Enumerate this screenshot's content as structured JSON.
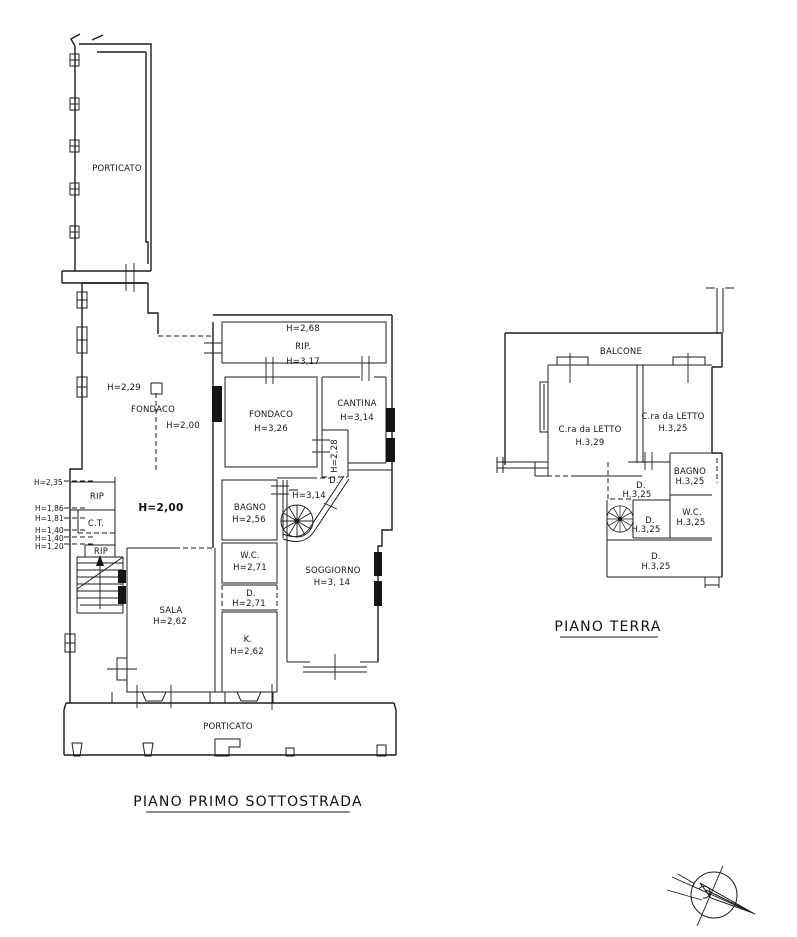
{
  "page": {
    "background": "#ffffff",
    "ink": "#1c1c1c"
  },
  "plan_primo": {
    "title": "PIANO PRIMO SOTTOSTRADA",
    "porticato_top": "PORTICATO",
    "porticato_bottom": "PORTICATO",
    "rooms": {
      "rip_top": {
        "h_upper": "H=2,68",
        "name": "RIP.",
        "h_lower": "H=3,17"
      },
      "fondaco_left": {
        "h_left": "H=2,29",
        "name": "FONDACO",
        "h_right": "H=2,00"
      },
      "fondaco_mid": {
        "name": "FONDACO",
        "h": "H=3,26"
      },
      "cantina": {
        "name": "CANTINA",
        "h": "H=3,14"
      },
      "corridor": {
        "h": "H=2,28"
      },
      "door_top": {
        "name": "D."
      },
      "stair_hall": {
        "h": "H=3,14"
      },
      "bagno": {
        "name": "BAGNO",
        "h": "H=2,56"
      },
      "hall": {
        "h_bold": "H=2,00"
      },
      "wc": {
        "name": "W.C.",
        "h": "H=2,71"
      },
      "disimpegno": {
        "name": "D.",
        "h": "H=2,71"
      },
      "cucina": {
        "name": "K.",
        "h": "H=2,62"
      },
      "sala": {
        "name": "SALA",
        "h": "H=2,62"
      },
      "soggiorno": {
        "name": "SOGGIORNO",
        "h": "H=3, 14"
      }
    },
    "left_labels": {
      "h235": "H=2,35",
      "rip1": "RIP",
      "h186": "H=1,86",
      "h181": "H=1,81",
      "ct": "C.T.",
      "h140a": "H=1,40",
      "h140b": "H=1,40",
      "h120": "H=1,20",
      "rip2": "RIP"
    }
  },
  "plan_terra": {
    "title": "PIANO TERRA",
    "balcone": "BALCONE",
    "rooms": {
      "letto1": {
        "name": "C.ra da LETTO",
        "h": "H.3,29"
      },
      "letto2": {
        "name": "C.ra da LETTO",
        "h": "H.3,25"
      },
      "bagno": {
        "name": "BAGNO",
        "h": "H.3,25"
      },
      "d1": {
        "name": "D.",
        "h": "H.3,25"
      },
      "wc": {
        "name": "W.C.",
        "h": "H.3,25"
      },
      "d2": {
        "name": "D.",
        "h": "H.3,25"
      },
      "d3": {
        "name": "D.",
        "h": "H.3,25"
      }
    }
  },
  "compass": {
    "meaning": "north-arrow"
  }
}
